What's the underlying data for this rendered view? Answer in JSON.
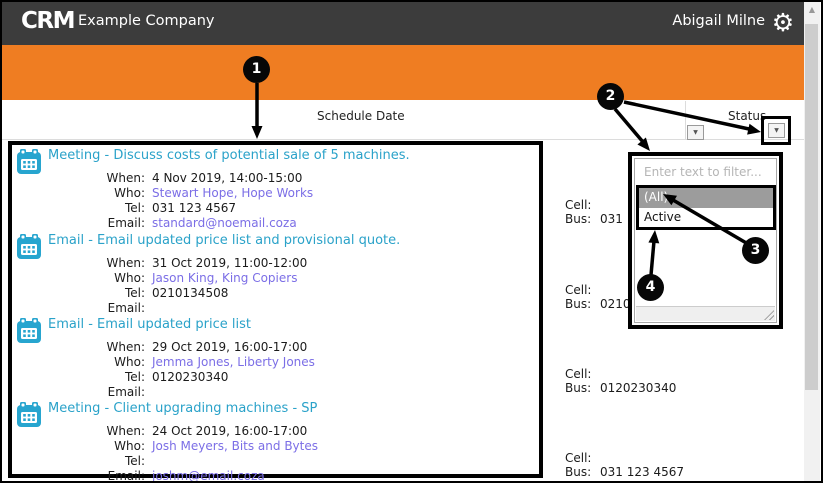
{
  "header": {
    "logo": "CRM",
    "company": "Example Company",
    "user": "Abigail Milne"
  },
  "toolbar": {
    "title": "Warnings"
  },
  "columns": {
    "schedule_date": "Schedule Date",
    "status": "Status"
  },
  "labels": {
    "when": "When:",
    "who": "Who:",
    "tel": "Tel:",
    "email": "Email:",
    "cell": "Cell:",
    "bus": "Bus:"
  },
  "appointments": [
    {
      "title": "Meeting - Discuss costs of potential sale of 5 machines.",
      "when": "4 Nov 2019, 14:00-15:00",
      "who": "Stewart Hope, Hope Works",
      "tel": "031 123 4567",
      "email": "standard@noemail.coza",
      "cell": "",
      "bus": "031 123 4567"
    },
    {
      "title": "Email - Email updated price list and provisional quote.",
      "when": "31 Oct 2019, 11:00-12:00",
      "who": "Jason King, King Copiers",
      "tel": "0210134508",
      "email": "",
      "cell": "",
      "bus": "0210134508"
    },
    {
      "title": "Email - Email updated price list",
      "when": "29 Oct 2019, 16:00-17:00",
      "who": "Jemma Jones, Liberty Jones",
      "tel": "0120230340",
      "email": "",
      "cell": "",
      "bus": "0120230340"
    },
    {
      "title": "Meeting - Client upgrading machines - SP",
      "when": "24 Oct 2019, 16:00-17:00",
      "who": "Josh Meyers, Bits and Bytes",
      "tel": "",
      "email": "joshm@email.coza",
      "cell": "",
      "bus": "031 123 4567"
    }
  ],
  "filter_popup": {
    "placeholder": "Enter text to filter...",
    "options": [
      {
        "label": "(All)",
        "selected": true
      },
      {
        "label": "Active",
        "selected": false
      }
    ]
  },
  "callouts": {
    "c1": "1",
    "c2": "2",
    "c3": "3",
    "c4": "4"
  },
  "icons": {
    "gear": "⚙",
    "refresh": "↻",
    "dropdown": "▼",
    "scroll_up": "▲"
  },
  "colors": {
    "accent_orange": "#ef7d22",
    "header_dark": "#3c3c3c",
    "title_cyan": "#2aa2c9",
    "link_purple": "#7b6ee6",
    "selected_gray": "#9c9c9c"
  }
}
